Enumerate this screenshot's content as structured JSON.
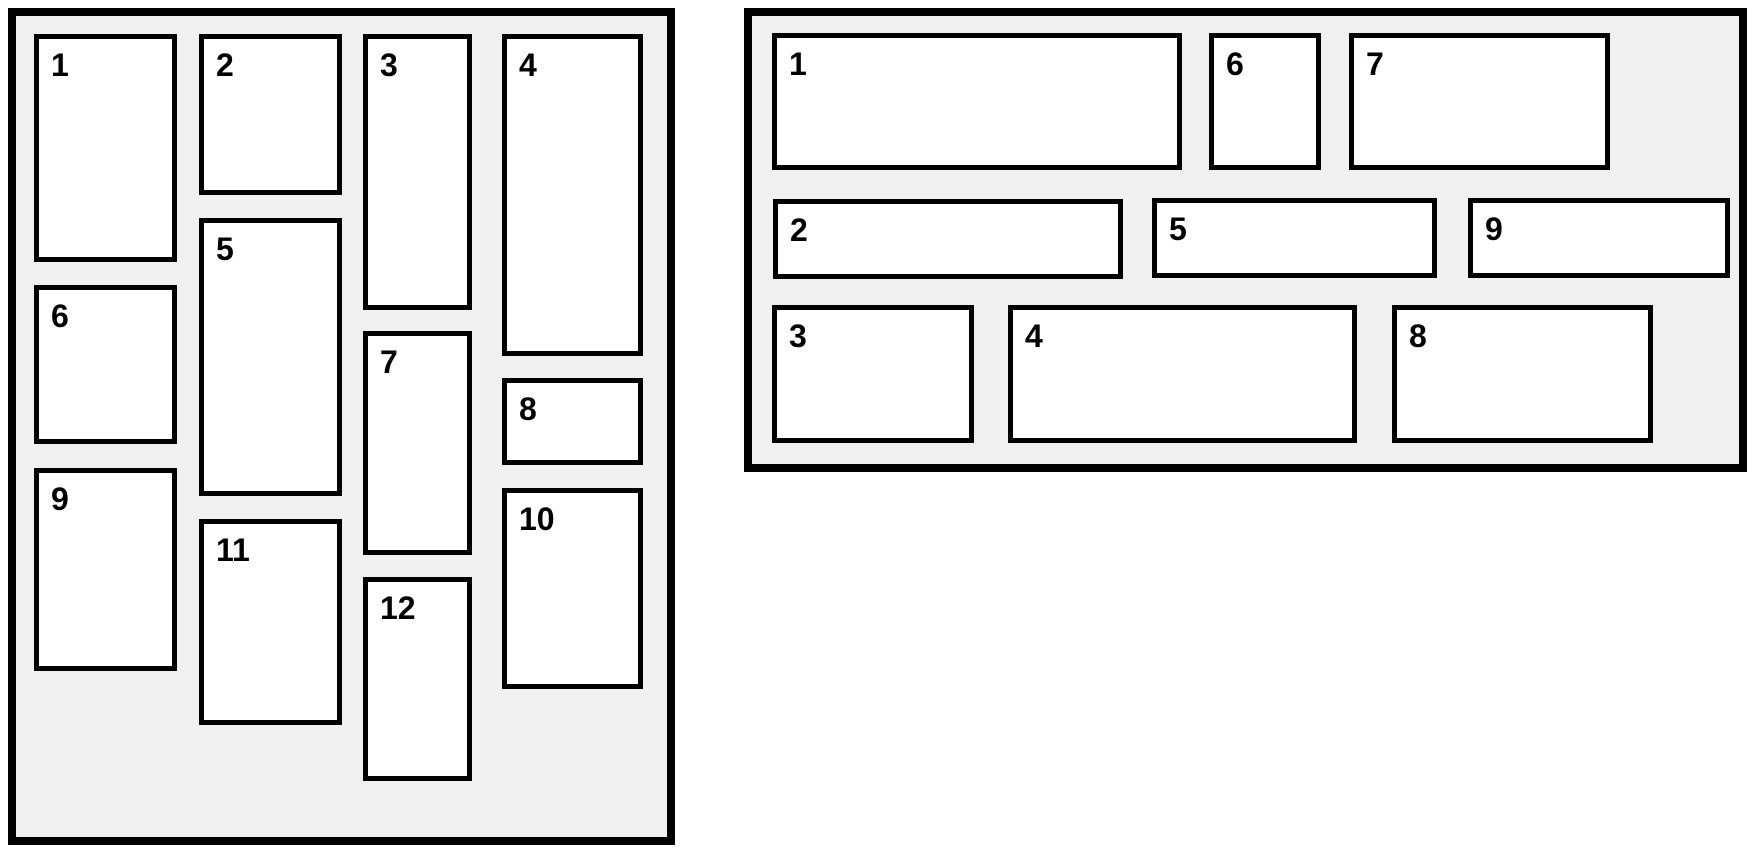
{
  "diagram": {
    "title": "layout-comparison-diagram",
    "colors": {
      "page_background": "#ffffff",
      "panel_background": "#f0f0f0",
      "box_background": "#ffffff",
      "border": "#000000",
      "label": "#000000"
    },
    "panels": [
      {
        "id": "panel-left",
        "name": "masonry-panel",
        "x": 8,
        "y": 8,
        "width": 667,
        "height": 837,
        "boxes": [
          {
            "label": "1",
            "x": 18,
            "y": 18,
            "w": 143,
            "h": 228
          },
          {
            "label": "2",
            "x": 183,
            "y": 18,
            "w": 143,
            "h": 161
          },
          {
            "label": "3",
            "x": 347,
            "y": 18,
            "w": 109,
            "h": 276
          },
          {
            "label": "4",
            "x": 486,
            "y": 18,
            "w": 141,
            "h": 322
          },
          {
            "label": "5",
            "x": 183,
            "y": 202,
            "w": 143,
            "h": 278
          },
          {
            "label": "6",
            "x": 18,
            "y": 269,
            "w": 143,
            "h": 159
          },
          {
            "label": "7",
            "x": 347,
            "y": 315,
            "w": 109,
            "h": 224
          },
          {
            "label": "8",
            "x": 486,
            "y": 362,
            "w": 141,
            "h": 87
          },
          {
            "label": "9",
            "x": 18,
            "y": 452,
            "w": 143,
            "h": 203
          },
          {
            "label": "10",
            "x": 486,
            "y": 472,
            "w": 141,
            "h": 201
          },
          {
            "label": "11",
            "x": 183,
            "y": 503,
            "w": 143,
            "h": 206
          },
          {
            "label": "12",
            "x": 347,
            "y": 561,
            "w": 109,
            "h": 204
          }
        ]
      },
      {
        "id": "panel-right",
        "name": "rows-panel",
        "x": 744,
        "y": 8,
        "width": 1003,
        "height": 464,
        "boxes": [
          {
            "label": "1",
            "x": 20,
            "y": 17,
            "w": 410,
            "h": 137
          },
          {
            "label": "2",
            "x": 21,
            "y": 183,
            "w": 350,
            "h": 80
          },
          {
            "label": "3",
            "x": 20,
            "y": 289,
            "w": 202,
            "h": 138
          },
          {
            "label": "4",
            "x": 256,
            "y": 289,
            "w": 349,
            "h": 138
          },
          {
            "label": "5",
            "x": 400,
            "y": 182,
            "w": 285,
            "h": 80
          },
          {
            "label": "6",
            "x": 457,
            "y": 17,
            "w": 112,
            "h": 137
          },
          {
            "label": "7",
            "x": 597,
            "y": 17,
            "w": 261,
            "h": 137
          },
          {
            "label": "8",
            "x": 640,
            "y": 289,
            "w": 261,
            "h": 138
          },
          {
            "label": "9",
            "x": 716,
            "y": 182,
            "w": 262,
            "h": 80
          }
        ]
      }
    ]
  }
}
